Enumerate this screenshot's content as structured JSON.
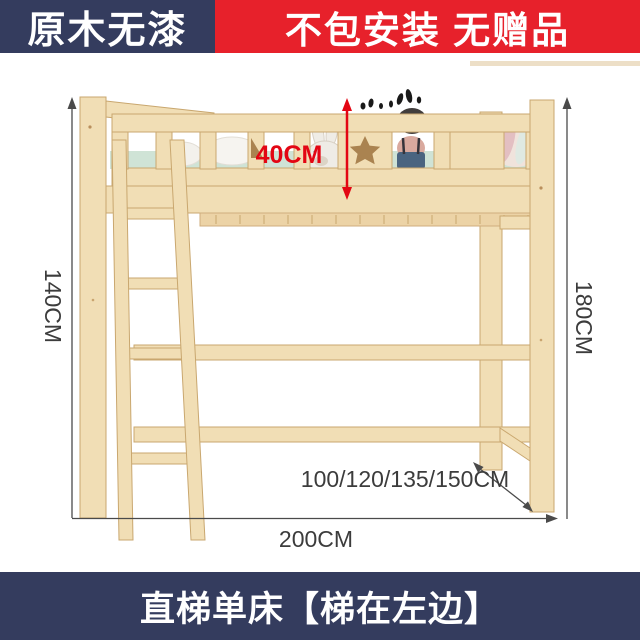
{
  "banners": {
    "top_left": "原木无漆",
    "top_right": "不包安装 无赠品",
    "bottom": "直梯单床【梯在左边】"
  },
  "dimensions": {
    "guardrail_height": "40CM",
    "left_height": "140CM",
    "right_height": "180CM",
    "width_options": "100/120/135/150CM",
    "length": "200CM"
  },
  "colors": {
    "banner_navy": "#343c5e",
    "banner_red": "#e7212b",
    "accent_red": "#e30613",
    "wood": "#f1deb5",
    "wood_edge": "#c9a76f",
    "mattress_mint": "#cfe3d6",
    "dim_line": "#4a4a4a",
    "dim_text": "#3c3c3c"
  }
}
